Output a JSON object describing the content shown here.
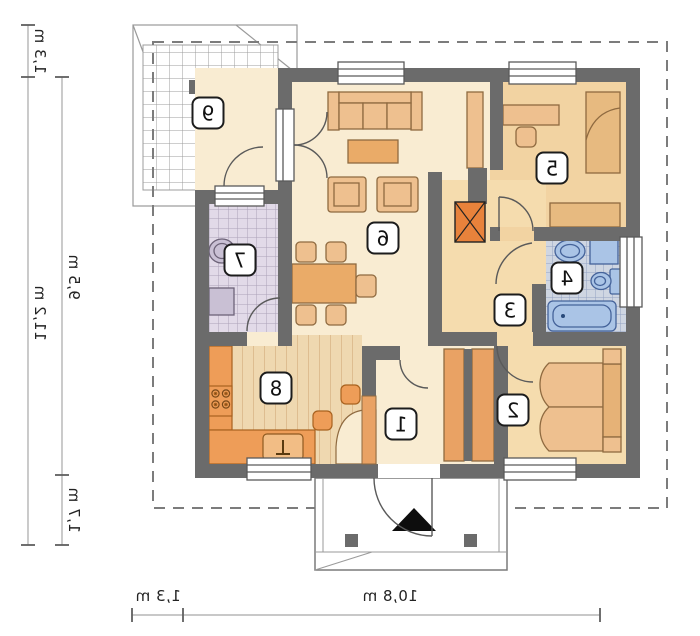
{
  "rooms": [
    {
      "number": "1"
    },
    {
      "number": "2"
    },
    {
      "number": "3"
    },
    {
      "number": "4"
    },
    {
      "number": "5"
    },
    {
      "number": "6"
    },
    {
      "number": "7"
    },
    {
      "number": "8"
    },
    {
      "number": "9"
    }
  ],
  "dimensions": {
    "left_top": "1,3 m",
    "left_total": "11,2 m",
    "left_main": "9,5 m",
    "left_lower": "1,7 m",
    "bottom_left": "1,3 m",
    "bottom_total": "10,8 m"
  },
  "colors": {
    "wall": "#6b6b6b",
    "floor_cream": "#f9ecd2",
    "floor_tan": "#f5dcae",
    "floor_tan_dark": "#f2d3a2",
    "tile_utility": "#e2dae8",
    "tile_bath": "#cfd6e2",
    "wood_floor": "#efd8b0",
    "counter_orange": "#ee9d58",
    "furniture_tan": "#eec08f",
    "wardrobe_orange": "#e9a264",
    "fireplace_orange": "#e8823b",
    "fixture_blue": "#aac4e6"
  }
}
